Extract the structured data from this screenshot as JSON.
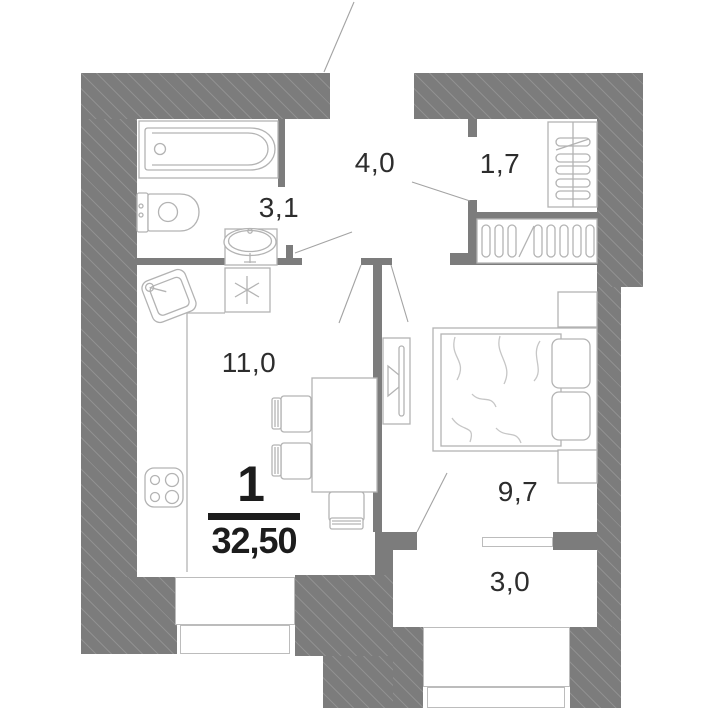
{
  "apartment": {
    "rooms_count": "1",
    "total_area": "32,50"
  },
  "rooms": {
    "hallway": {
      "area": "4,0"
    },
    "storage": {
      "area": "1,7"
    },
    "bathroom": {
      "area": "3,1"
    },
    "kitchen_living": {
      "area": "11,0"
    },
    "bedroom": {
      "area": "9,7"
    },
    "balcony": {
      "area": "3,0"
    }
  },
  "colors": {
    "wall": "#7c7c7c",
    "wall_hatch": "#909090",
    "furniture_outline": "#b3b3b3",
    "door_swing_line": "#a3a3a3",
    "label_text": "#2d2d2d",
    "accent_text": "#1c1c1c",
    "background": "#ffffff"
  },
  "icons": {
    "vent_symbol": "six-ray-asterisk",
    "fixtures": [
      "bathtub",
      "toilet",
      "washbasin",
      "kitchen-sink",
      "stove",
      "dining-table",
      "chair",
      "bed",
      "pillow",
      "tv",
      "wardrobe-hangers",
      "shelf-rack"
    ]
  }
}
